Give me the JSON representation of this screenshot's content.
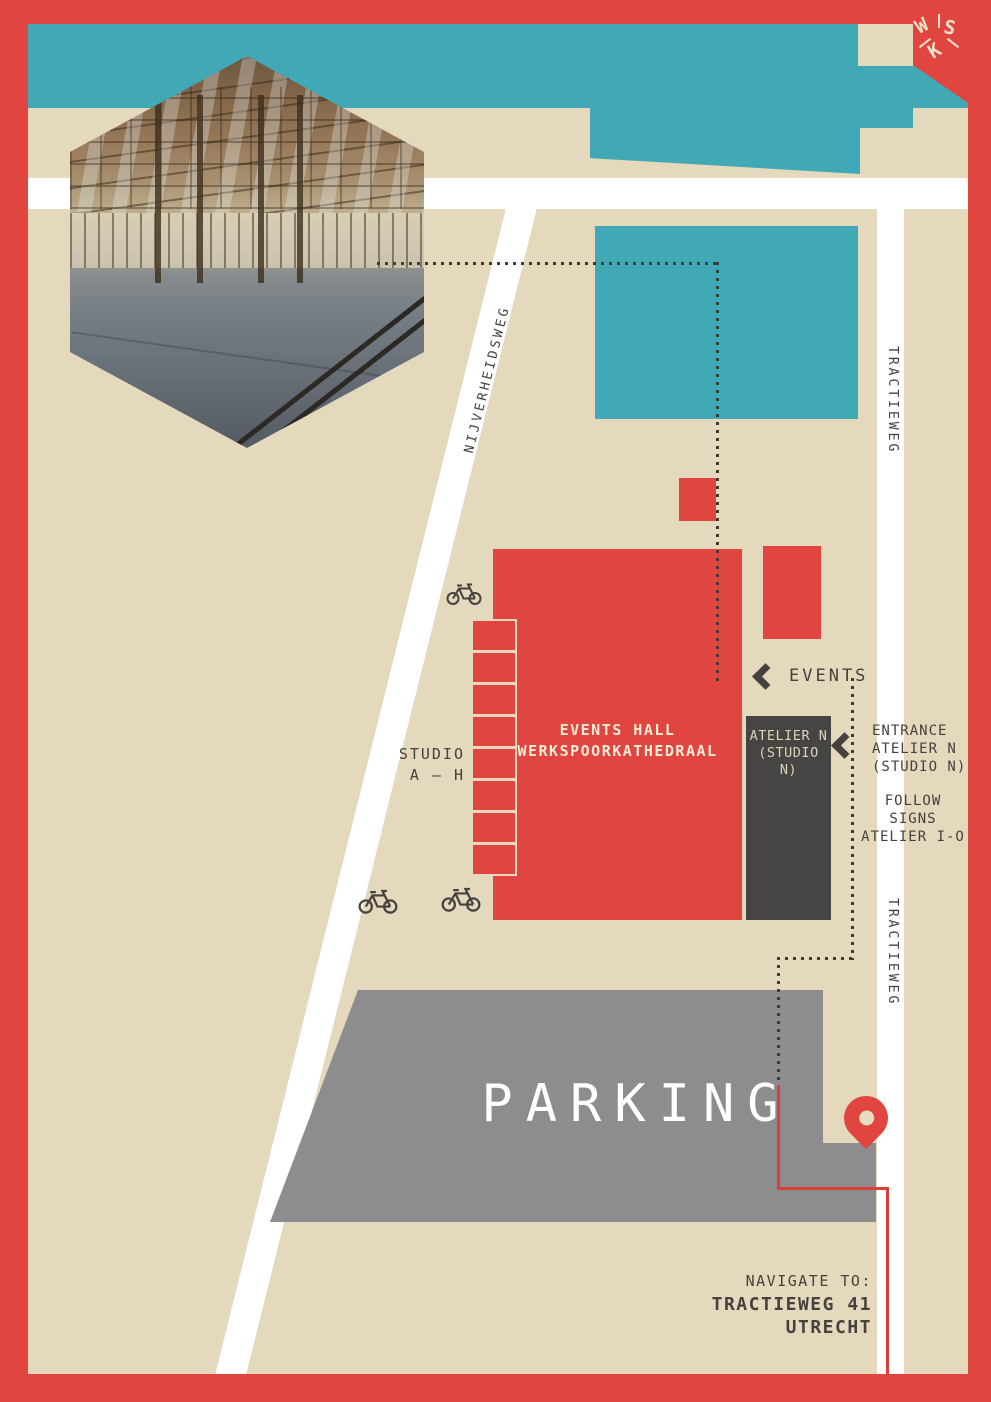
{
  "colors": {
    "red": "#e0453f",
    "teal": "#41a8b5",
    "beige": "#e4d8bd",
    "dark_text": "#45413c",
    "building_dark": "#474543",
    "parking_gray": "#8d8d90",
    "road_white": "#ffffff",
    "cream": "#f2e4cc",
    "route_red": "#d84038"
  },
  "badge": {
    "w": "W",
    "s": "S",
    "k": "K"
  },
  "streets": {
    "nijverheidsweg": "NIJVERHEIDSWEG",
    "tractieweg_top": "TRACTIEWEG",
    "tractieweg_mid": "TRACTIEWEG"
  },
  "map": {
    "events_hall": {
      "line1": "EVENTS HALL",
      "line2": "WERKSPOORKATHEDRAAL"
    },
    "atelier": {
      "line1": "ATELIER N",
      "line2": "(STUDIO N)"
    },
    "studio_strip_count": 8,
    "parking_label": "PARKING"
  },
  "annotations": {
    "events": "EVENTS",
    "studio_range": {
      "line1": "STUDIO",
      "line2": "A – H"
    },
    "entrance": {
      "line1": "ENTRANCE",
      "line2": "ATELIER N",
      "line3": "(STUDIO N)"
    },
    "follow": {
      "line1": "FOLLOW",
      "line2": "SIGNS",
      "line3": "ATELIER I-O"
    },
    "navigate": {
      "line1": "NAVIGATE TO:",
      "line2": "TRACTIEWEG 41",
      "line3": "UTRECHT"
    }
  }
}
